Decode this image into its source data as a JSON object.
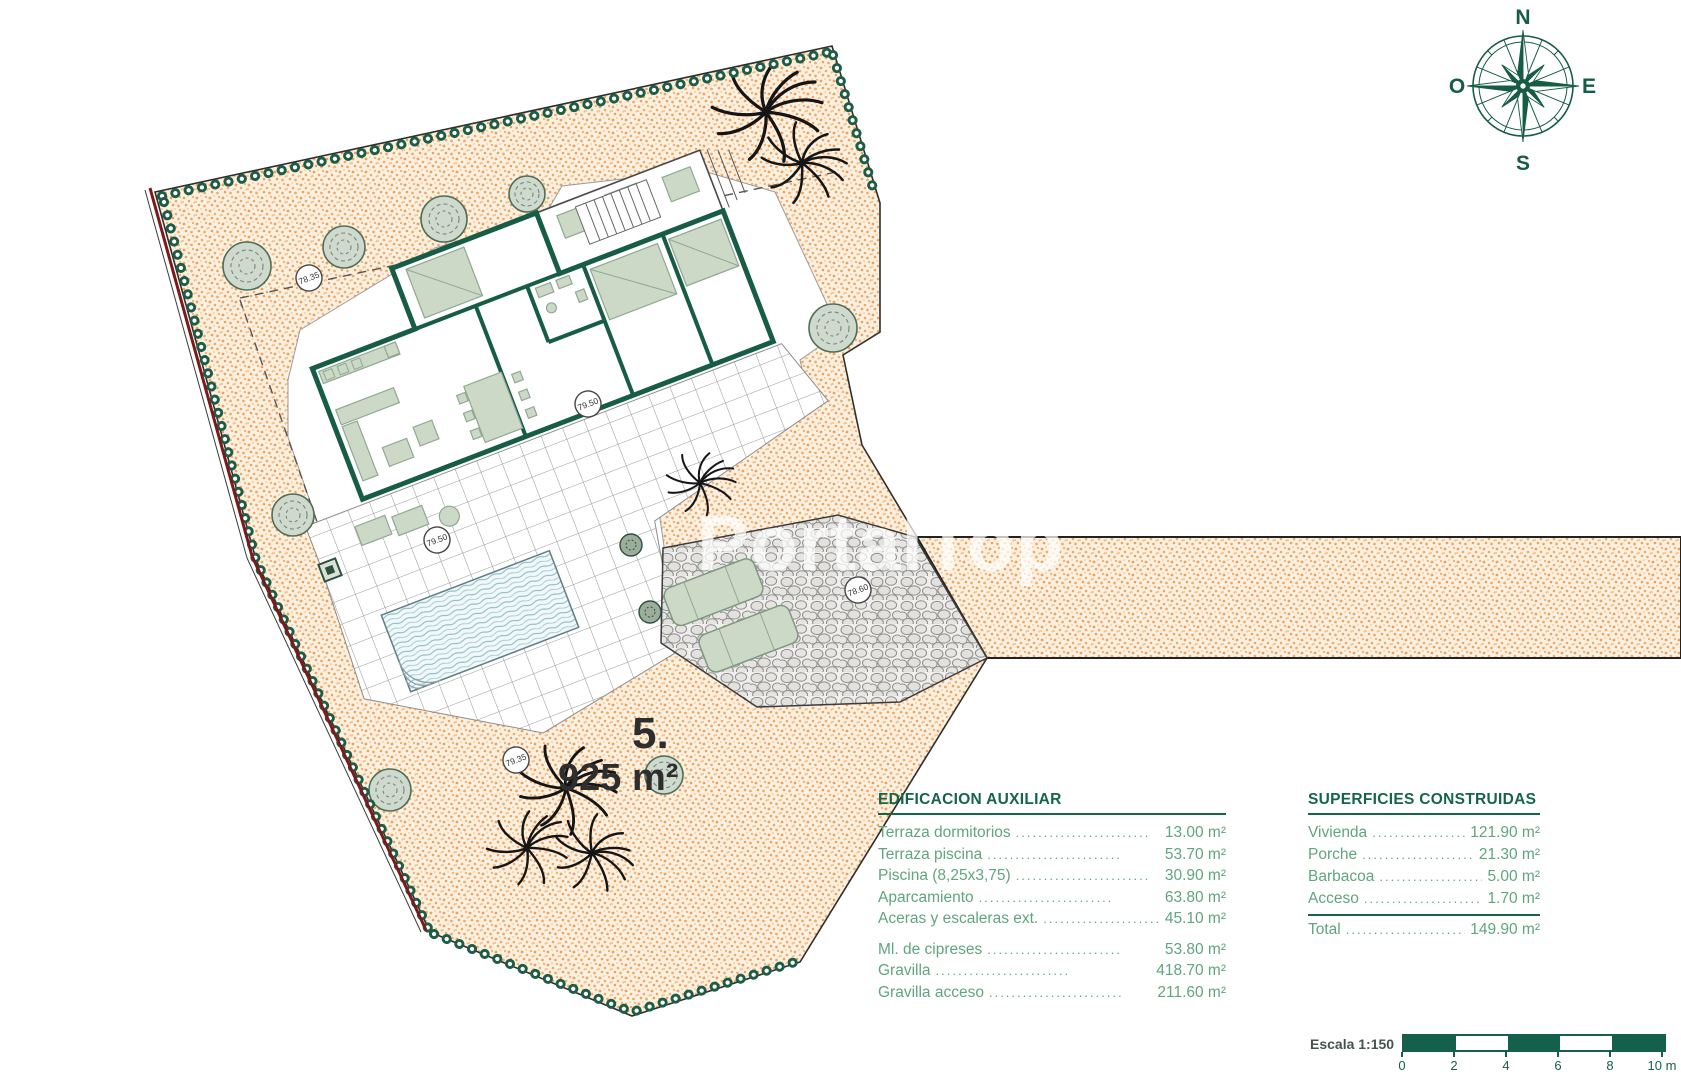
{
  "plan": {
    "plot_number": "5.",
    "plot_area": "925 m²",
    "watermark": "PortalTop",
    "spot_elevations": [
      "78.35",
      "79.50",
      "79.50",
      "79.35",
      "78.60"
    ]
  },
  "compass": {
    "north": "N",
    "south": "S",
    "east": "E",
    "west": "O"
  },
  "tables": {
    "leader": "........................",
    "aux": {
      "title": "EDIFICACION AUXILIAR",
      "rows": [
        {
          "label": "Terraza dormitorios",
          "value": "13.00 m²"
        },
        {
          "label": "Terraza piscina",
          "value": "53.70 m²"
        },
        {
          "label": "Piscina (8,25x3,75)",
          "value": "30.90 m²"
        },
        {
          "label": "Aparcamiento",
          "value": "63.80 m²"
        },
        {
          "label": "Aceras y escaleras ext.",
          "value": "45.10 m²"
        },
        {
          "label": "Ml. de cipreses",
          "value": "53.80 m²"
        },
        {
          "label": "Gravilla",
          "value": "418.70 m²"
        },
        {
          "label": "Gravilla acceso",
          "value": "211.60 m²"
        }
      ]
    },
    "built": {
      "title": "SUPERFICIES CONSTRUIDAS",
      "rows": [
        {
          "label": "Vivienda",
          "value": "121.90 m²"
        },
        {
          "label": "Porche",
          "value": "21.30 m²"
        },
        {
          "label": "Barbacoa",
          "value": "5.00 m²"
        },
        {
          "label": "Acceso",
          "value": "1.70 m²"
        }
      ],
      "total": {
        "label": "Total",
        "value": "149.90 m²"
      }
    }
  },
  "scalebar": {
    "label": "Escala 1:150",
    "ticks": [
      "0",
      "2",
      "4",
      "6",
      "8",
      "10 m"
    ]
  },
  "colors": {
    "accent_green": "#156549",
    "text_green": "#5fa57d",
    "wall_green": "#175c44",
    "gravel_orange": "#efa35e",
    "boundary_red": "#7c1a1a",
    "pool_blue": "#84b7c1"
  }
}
